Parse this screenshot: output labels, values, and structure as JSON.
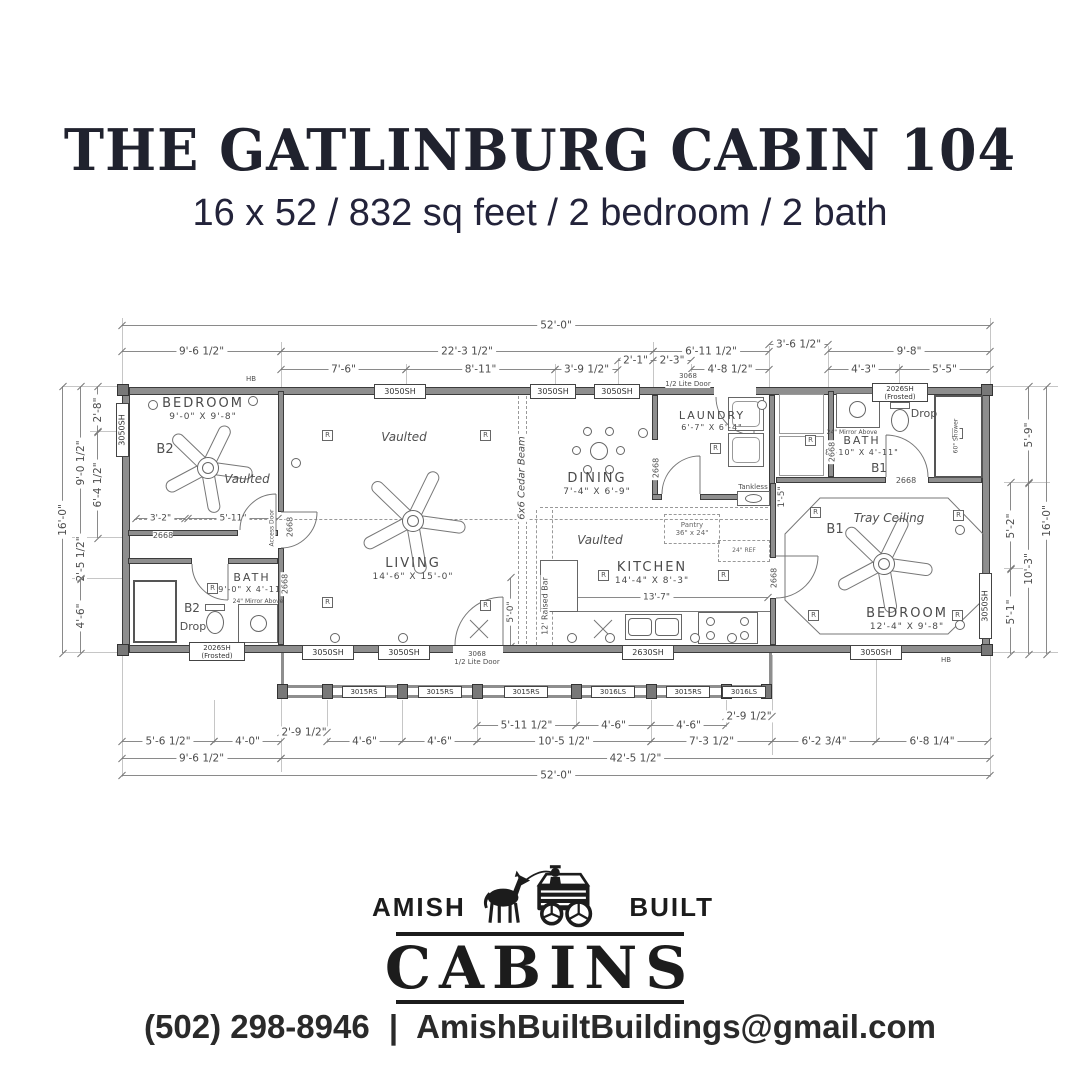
{
  "header": {
    "title": "THE GATLINBURG CABIN 104",
    "subtitle": "16 x 52 / 832 sq feet / 2 bedroom / 2 bath"
  },
  "footer": {
    "brand_left": "AMISH",
    "brand_right": "BUILT",
    "brand_main": "CABINS",
    "phone": "(502) 298-8946",
    "separator": "|",
    "email": "AmishBuiltBuildings@gmail.com"
  },
  "plan": {
    "rooms": {
      "bedroom2": {
        "name": "BEDROOM",
        "size": "9'-0\" X 9'-8\"",
        "tag": "B2",
        "ceiling": "Vaulted"
      },
      "living": {
        "name": "LIVING",
        "size": "14'-6\" X 15'-0\"",
        "ceiling": "Vaulted"
      },
      "dining": {
        "name": "DINING",
        "size": "7'-4\" X 6'-9\""
      },
      "kitchen": {
        "name": "KITCHEN",
        "size": "14'-4\" X 8'-3\"",
        "ceiling": "Vaulted"
      },
      "laundry": {
        "name": "LAUNDRY",
        "size": "6'-7\" X 6'-4\""
      },
      "bath2": {
        "name": "BATH",
        "size": "9'-0\" X 4'-11\"",
        "tag": "B2",
        "note": "Drop"
      },
      "bath1": {
        "name": "BATH",
        "size": "8'-10\" X 4'-11\"",
        "tag": "B1",
        "note": "Drop"
      },
      "bedroom1": {
        "name": "BEDROOM",
        "size": "12'-4\" X 9'-8\"",
        "tag": "B1",
        "ceiling": "Tray Ceiling"
      }
    },
    "features": {
      "cedar_beam": "6x6 Cedar Beam",
      "raised_bar": "12' Raised Bar",
      "pantry_line1": "Pantry",
      "pantry_line2": "36\" x 24\"",
      "ref": "24\" REF",
      "tankless": "Tankless",
      "mirror": "24\" Mirror Above",
      "shower60": "60\" Shower",
      "access_door": "Access Door",
      "hose_bib": "HB",
      "recessed": "R"
    },
    "codes": {
      "door_2668": "2668",
      "door_3068_l1": "3068",
      "door_3068_l2": "1/2 Lite Door",
      "win_3050": "3050SH",
      "win_2026_l1": "2026SH",
      "win_2026_l2": "(Frosted)",
      "win_2630": "2630SH",
      "rail_3015": "3015RS",
      "rail_3016": "3016LS"
    },
    "dims": {
      "top": {
        "total": "52'-0\"",
        "a": "9'-6 1/2\"",
        "b": "22'-3 1/2\"",
        "c": "6'-11 1/2\"",
        "d": "3'-6 1/2\"",
        "e": "9'-8\"",
        "f": "7'-6\"",
        "g": "8'-11\"",
        "h": "3'-9 1/2\"",
        "i": "2'-1\"",
        "j": "2'-3\"",
        "k": "4'-8 1/2\"",
        "l": "4'-3\"",
        "m": "5'-5\""
      },
      "left": {
        "a": "2'-8\"",
        "b": "9'-0 1/2\"",
        "c": "6'-4 1/2\"",
        "d": "16'-0\"",
        "e": "2'-5 1/2\"",
        "f": "4'-6\""
      },
      "right": {
        "a": "5'-9\"",
        "b": "5'-2\"",
        "c": "10'-3\"",
        "d": "5'-1\"",
        "e": "16'-0\""
      },
      "bottom": {
        "a": "2'-9 1/2\"",
        "b": "4'-6\"",
        "c": "4'-6\"",
        "d": "5'-11 1/2\"",
        "e": "4'-6\"",
        "f": "4'-6\"",
        "g": "2'-9 1/2\"",
        "h": "5'-6 1/2\"",
        "i": "4'-0\"",
        "j": "10'-5 1/2\"",
        "k": "7'-3 1/2\"",
        "l": "6'-2 3/4\"",
        "m": "6'-8 1/4\"",
        "n": "9'-6 1/2\"",
        "o": "42'-5 1/2\"",
        "total": "52'-0\""
      },
      "interior": {
        "a": "3'-2\"",
        "b": "5'-11\"",
        "c": "13'-7\"",
        "d": "5'-0\"",
        "e": "1'-5\""
      }
    }
  }
}
